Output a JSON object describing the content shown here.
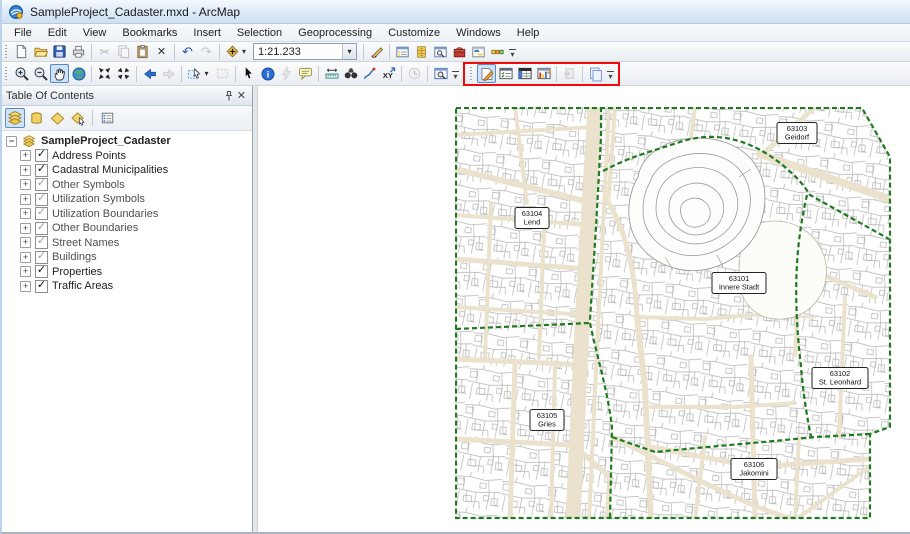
{
  "window": {
    "title": "SampleProject_Cadaster.mxd - ArcMap"
  },
  "menu": {
    "items": [
      "File",
      "Edit",
      "View",
      "Bookmarks",
      "Insert",
      "Selection",
      "Geoprocessing",
      "Customize",
      "Windows",
      "Help"
    ]
  },
  "standard_toolbar": {
    "scale_value": "1:21.233",
    "icons": [
      "new-document",
      "open",
      "save",
      "print",
      "cut",
      "copy",
      "paste",
      "delete",
      "undo",
      "redo",
      "add-data"
    ],
    "right_icons": [
      "editor-sketch",
      "table-of-contents-window",
      "catalog-window",
      "search-window",
      "arctoolbox",
      "python-window",
      "modelbuilder"
    ]
  },
  "tools_toolbar": {
    "active_tool": "pan",
    "icons": [
      "zoom-in",
      "zoom-out",
      "pan",
      "full-extent",
      "fixed-zoom-in",
      "fixed-zoom-out",
      "go-back-extent",
      "go-forward-extent",
      "select-features",
      "clear-selection",
      "select-elements",
      "identify",
      "hyperlink",
      "html-popup",
      "measure",
      "find",
      "find-route",
      "go-to-xy",
      "time-slider",
      "viewer-window"
    ]
  },
  "highlighted_toolbar": {
    "highlight_color": "#f10c0c",
    "active_icon": "edit-document",
    "icons": [
      "edit-document",
      "attributes-window",
      "table-window",
      "layout-window",
      "paste-special",
      "copy-pages"
    ]
  },
  "toc": {
    "title": "Table Of Contents",
    "tools": [
      "list-by-drawing-order",
      "list-by-source",
      "list-by-visibility",
      "list-by-selection",
      "options"
    ],
    "root_label": "SampleProject_Cadaster",
    "layers": [
      {
        "label": "Address Points",
        "checked": true,
        "dimmed": false
      },
      {
        "label": "Cadastral Municipalities",
        "checked": true,
        "dimmed": false
      },
      {
        "label": "Other Symbols",
        "checked": true,
        "dimmed": true
      },
      {
        "label": "Utilization Symbols",
        "checked": true,
        "dimmed": true
      },
      {
        "label": "Utilization Boundaries",
        "checked": true,
        "dimmed": true
      },
      {
        "label": "Other Boundaries",
        "checked": true,
        "dimmed": true
      },
      {
        "label": "Street Names",
        "checked": true,
        "dimmed": true
      },
      {
        "label": "Buildings",
        "checked": true,
        "dimmed": true
      },
      {
        "label": "Properties",
        "checked": true,
        "dimmed": false
      },
      {
        "label": "Traffic Areas",
        "checked": true,
        "dimmed": false
      }
    ]
  },
  "map": {
    "labels": [
      {
        "code": "63103",
        "name": "Geidorf"
      },
      {
        "code": "63104",
        "name": "Lend"
      },
      {
        "code": "63101",
        "name": "Innere Stadt"
      },
      {
        "code": "63102",
        "name": "St. Leonhard"
      },
      {
        "code": "63105",
        "name": "Gries"
      },
      {
        "code": "63106",
        "name": "Jakomini"
      }
    ],
    "colors": {
      "municipal_boundary": "#1e7a1e",
      "street_fill": "#ebe2cd",
      "parcel_line": "#b3b3b3",
      "label_border": "#222222"
    }
  }
}
